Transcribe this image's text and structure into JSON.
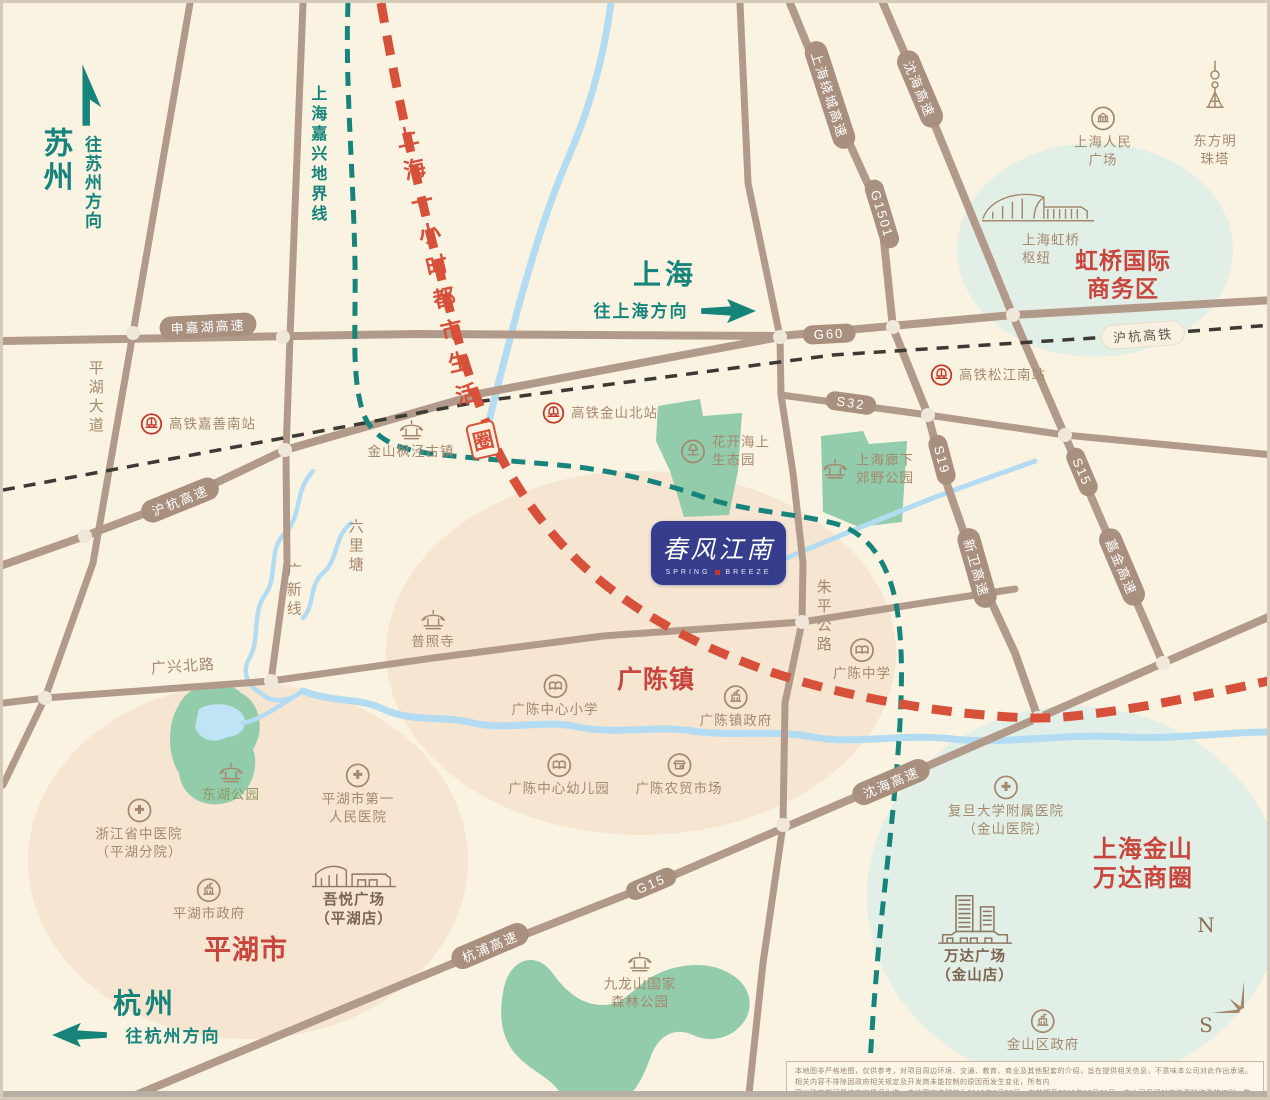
{
  "colors": {
    "background_cream": "#FBF3E2",
    "road_taupe": "#B29A8A",
    "label_brown": "#A5896F",
    "teal_accent": "#17847B",
    "red_dashed_line": "#D7503A",
    "red_zone_text": "#C8463E",
    "park_green": "#92CCAA",
    "water_blue": "#B3DCF2",
    "beige_zone": "#F5E5D1",
    "mint_zone": "#E2EFE7",
    "logo_navy": "#363D8C",
    "rail_icon_red": "#C13A2C"
  },
  "corners": {
    "suzhou_city": "苏州",
    "suzhou_dir": "往苏州方向",
    "shanghai_city": "上海",
    "shanghai_dir": "往上海方向",
    "hangzhou_city": "杭州",
    "hangzhou_dir": "往杭州方向",
    "boundary": "上海嘉兴地界线"
  },
  "life_circle": {
    "text": "上海一小时都市生活",
    "badge": "圈"
  },
  "roads": {
    "shenjiahu": "申嘉湖高速",
    "g60": "G60",
    "huhang_expwy": "沪杭高速",
    "huhang_rail": "沪杭高铁",
    "s32": "S32",
    "g1501": "G1501",
    "raocheng": "上海绕城高速",
    "shenhai_north": "沈海高速",
    "s19": "S19",
    "xinwei": "新卫高速",
    "s15": "S15",
    "jiajin": "嘉金高速",
    "shenhai_south": "沈海高速",
    "hangpu": "杭浦高速",
    "g15": "G15",
    "pinghu_avenue": "平湖大道",
    "guangxin_line": "广新线",
    "liulitang": "六里塘",
    "zhuping_road": "朱平公路",
    "guangxing_road": "广兴北路"
  },
  "zones": {
    "hongqiao_biz": "虹桥国际\n商务区",
    "guangchen_town": "广陈镇",
    "pinghu_city": "平湖市",
    "wanda_circle": "上海金山万达商圈"
  },
  "pois": {
    "jiashan_south_station": "高铁嘉善南站",
    "fengjing_town": "金山枫泾古镇",
    "jinshan_north_station": "高铁金山北站",
    "songjiang_south_station": "高铁松江南站",
    "flower_sea_park": "花开海上\n生态园",
    "langxia_park": "上海廊下\n郊野公园",
    "renmin_square": "上海人民\n广场",
    "pearl_tower": "东方明珠塔",
    "hongqiao_hub": "上海虹桥\n枢纽",
    "puzhao_temple": "普照寺",
    "gc_primary_school": "广陈中心小学",
    "gc_town_gov": "广陈镇政府",
    "gc_middle_school": "广陈中学",
    "gc_kindergarten": "广陈中心幼儿园",
    "gc_market": "广陈农贸市场",
    "donghu_park": "东湖公园",
    "zhejiang_hospital": "浙江省中医院\n（平湖分院）",
    "pinghu_hospital": "平湖市第一\n人民医院",
    "pinghu_gov": "平湖市政府",
    "wuyue_plaza": "吾悦广场\n（平湖店）",
    "fudan_hospital": "复旦大学附属医院\n（金山医院）",
    "wanda_plaza": "万达广场\n（金山店）",
    "jinshan_gov": "金山区政府",
    "jiulongshan_park": "九龙山国家\n森林公园"
  },
  "logo": {
    "title": "春风江南",
    "sub_left": "SPRING",
    "sub_right": "BREEZE"
  },
  "compass": {
    "north": "N",
    "south": "S"
  },
  "disclaimer": {
    "line1": "本地图非严格地图，仅供参考，对项目周边环境、交通、教育、商业及其他配套的介绍，旨在提供相关信息，不意味本公司对此作出承诺。相关内容不排除因政府相关规定及开发商未能控制的原因而发生变化，所有内",
    "line2": "容以政府部门最终审定情况为准。本地图宣传时效为2019年3月23日，有效期至2019年12月31日。本公司保留对宣传资料修改的权利，敬请留意最新资料。"
  }
}
